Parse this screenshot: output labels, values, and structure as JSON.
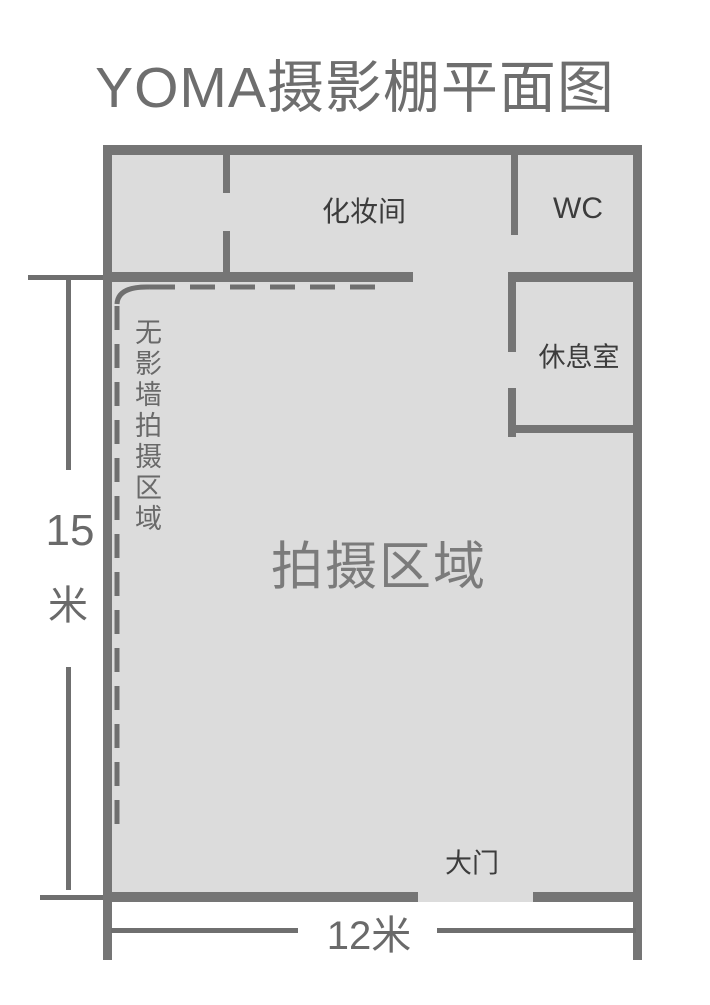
{
  "title": "YOMA摄影棚平面图",
  "rooms": {
    "makeup_label": "化妆间",
    "wc_label": "WC",
    "lounge_label": "休息室",
    "shooting_label": "拍摄区域",
    "seamless_label": "无影墙拍摄区域",
    "door_label": "大门"
  },
  "dimensions": {
    "height_value": "15",
    "height_unit": "米",
    "width_label": "12米"
  },
  "colors": {
    "wall": "#757575",
    "floor_fill": "#dcdcdc",
    "dashed_line": "#6f6f6f",
    "label_dark": "#3c3c3c",
    "label_light": "#7b7b7b",
    "dimension_text": "#6a6a6a",
    "title_text": "#6e6e6e",
    "background": "#ffffff"
  }
}
